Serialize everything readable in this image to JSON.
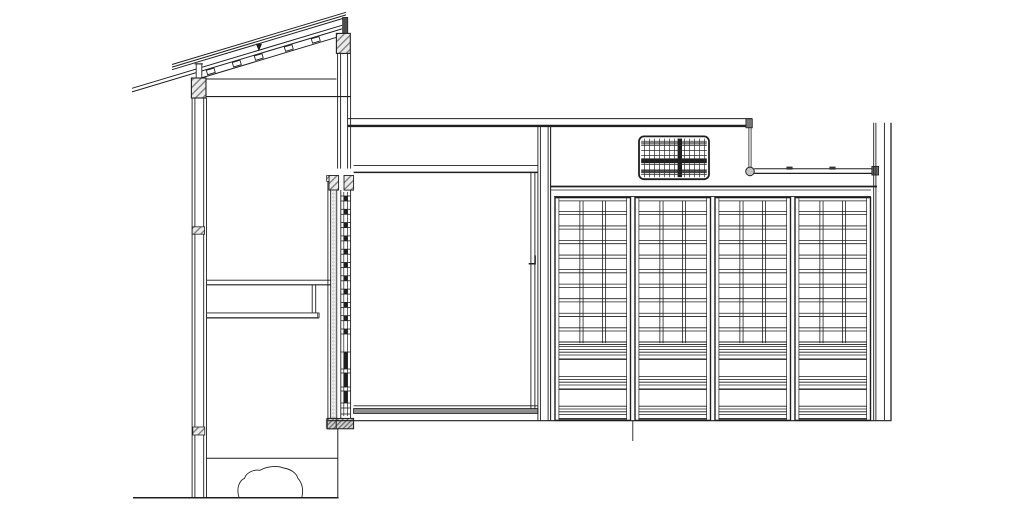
{
  "drawing": {
    "kind": "architectural-section-elevation",
    "colors": {
      "paper": "#ffffff",
      "ink": "#1f1f1f",
      "line_soft": "#2a2a2a",
      "hatch_fill": "#ececec",
      "hatch_line": "#777777",
      "sill_hatch_fill": "#cfcfcf",
      "dark_fill": "#4d4d4d",
      "gray_band": "#909090",
      "metal_gray": "#c4c4c4",
      "beam_cap_gray": "#777777",
      "rod_block_gray": "#6e6e6e",
      "amado_gray": "#d9d9d9"
    },
    "roof": {
      "roofing_line_count": 3,
      "sheathing_line_count": 2,
      "purlin_count": 5,
      "slope": 0.3
    },
    "left_wall": {
      "stud_line_count": 4,
      "tie_block_count": 2,
      "shelf_count": 2
    },
    "transom_vent": {
      "vertical_line_count": 12,
      "horizontal_line_count": 5,
      "dark_vertical_band_count": 1,
      "dark_horizontal_band_count": 3
    },
    "section_screens": {
      "leaf_count": 2,
      "kumiko_block_count": 11,
      "koshi_bar_count": 3
    },
    "shoji": {
      "panel_count": 4,
      "panel_pitch": 80,
      "panel_width": 75.5,
      "lattice_columns": 3,
      "lattice_rows": 10,
      "koshi_band_count": 3,
      "koshi_lines_per_band": 5
    },
    "rod": {
      "clip_count": 2,
      "ring_count": 1
    },
    "ground": {
      "stepping_stone_count": 1
    }
  }
}
